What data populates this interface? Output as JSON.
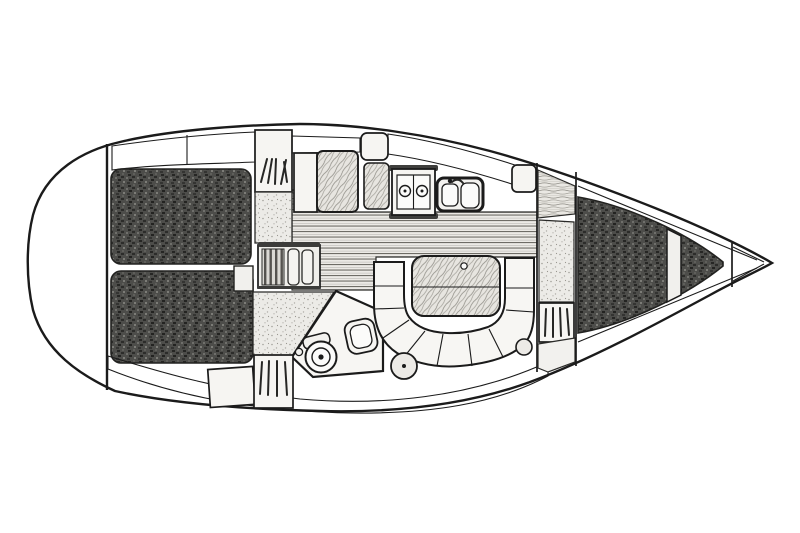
{
  "diagram": {
    "type": "boat-interior-plan",
    "subject": "Sailing yacht interior layout, overhead plan view",
    "orientation": {
      "bow": "right",
      "stern": "left"
    },
    "style": "black-and-white technical line drawing with stippled cushion shading, no text labels"
  },
  "palette": {
    "background": "#ffffff",
    "line": "#1b1b1b",
    "hull_fill": "#f1f0ed",
    "white_fill": "#f7f6f3",
    "dark_upholstery": "#4b4b49",
    "stipple_base": "#ecebe7",
    "wood_base": "#eae8e3",
    "flange_dark": "#3f3f3d"
  },
  "areas": [
    {
      "id": "aft-cabin",
      "label": "aft double-berth cabin at stern, two shaded cushion panels"
    },
    {
      "id": "companionway",
      "label": "companionway steps flanked by hanging lockers and stippled floor"
    },
    {
      "id": "head",
      "label": "head compartment with marine toilet and washbasin"
    },
    {
      "id": "nav-station",
      "label": "navigation chart table with seat"
    },
    {
      "id": "galley",
      "label": "galley with gimballed two-burner stove and double sink"
    },
    {
      "id": "saloon",
      "label": "saloon with U-shaped settee, wood table and two round stools"
    },
    {
      "id": "forward-cabin",
      "label": "forward V-berth cabin, shaded triangular cushion"
    },
    {
      "id": "anchor-locker",
      "label": "anchor locker at bow tip"
    }
  ],
  "counts": {
    "stove_burners": 2,
    "sink_basins": 2,
    "saloon_stools": 2,
    "berth_cushion_panels": 3,
    "hanging_locker_symbols": 4
  }
}
